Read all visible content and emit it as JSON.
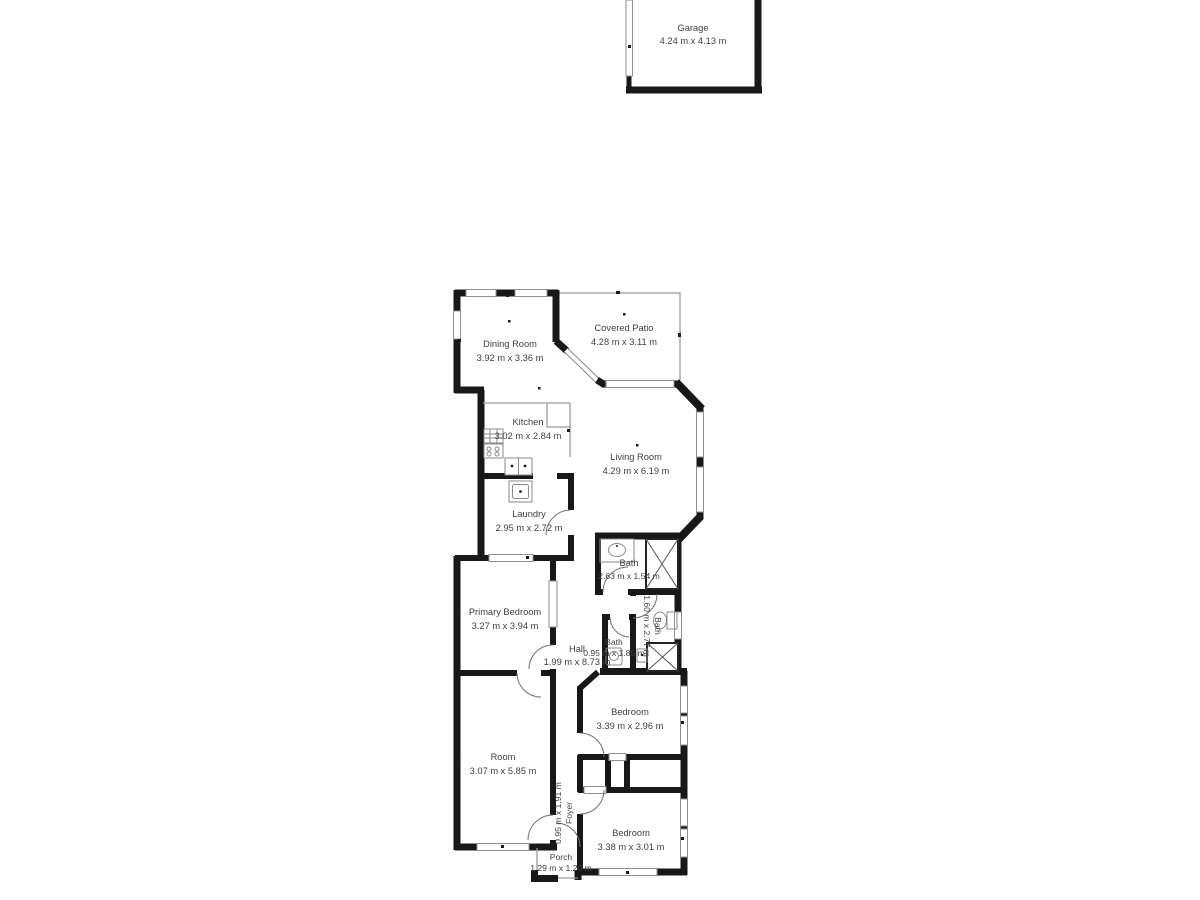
{
  "plan": {
    "wall_color": "#181818",
    "line_color": "#9b9b9b",
    "text_color": "#3e3e3e",
    "background": "#ffffff"
  },
  "rooms": [
    {
      "name": "Garage",
      "dims": "4.24 m x 4.13 m"
    },
    {
      "name": "Dining Room",
      "dims": "3.92 m x 3.36 m"
    },
    {
      "name": "Covered Patio",
      "dims": "4.28 m x 3.11 m"
    },
    {
      "name": "Kitchen",
      "dims": "3.02 m x 2.84 m"
    },
    {
      "name": "Living Room",
      "dims": "4.29 m x 6.19 m"
    },
    {
      "name": "Laundry",
      "dims": "2.95 m x 2.72 m"
    },
    {
      "name": "Bath",
      "dims": "2.63 m x 1.54 m"
    },
    {
      "name": "Bath",
      "dims": "1.60 m x 2.77 m"
    },
    {
      "name": "Primary Bedroom",
      "dims": "3.27 m x 3.94 m"
    },
    {
      "name": "Hall",
      "dims": "1.99 m x 8.73 m"
    },
    {
      "name": "Bath",
      "dims": "0.95 m x 1.85 m"
    },
    {
      "name": "Bedroom",
      "dims": "3.39 m x 2.96 m"
    },
    {
      "name": "Room",
      "dims": "3.07 m x 5.85 m"
    },
    {
      "name": "Foyer",
      "dims": "0.95 m x 1.91 m"
    },
    {
      "name": "Bedroom",
      "dims": "3.38 m x 3.01 m"
    },
    {
      "name": "Porch",
      "dims": "1.29 m x 1.20 m"
    }
  ]
}
